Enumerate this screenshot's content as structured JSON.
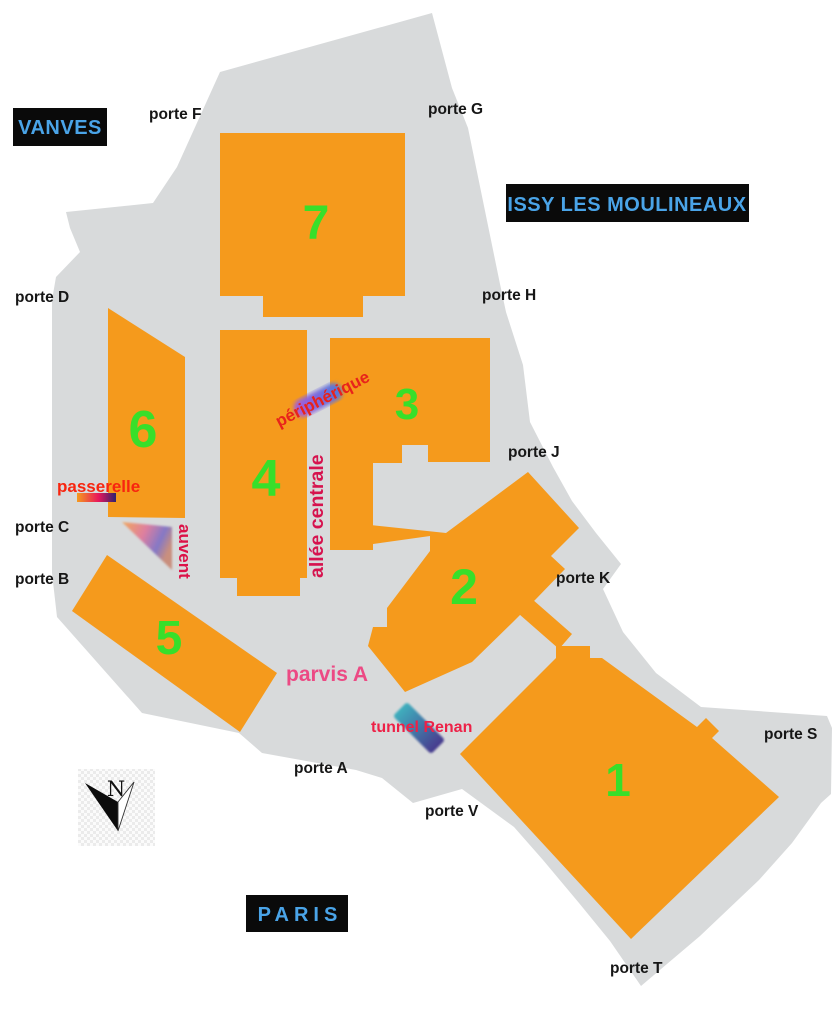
{
  "map": {
    "regions": {
      "vanves": "VANVES",
      "issy_les_moulineaux": "ISSY LES MOULINEAUX",
      "paris": "PARIS"
    },
    "halls": {
      "hall_1": "1",
      "hall_2": "2",
      "hall_3": "3",
      "hall_4": "4",
      "hall_5": "5",
      "hall_6": "6",
      "hall_7": "7"
    },
    "gates": {
      "porte_a": "porte A",
      "porte_b": "porte B",
      "porte_c": "porte C",
      "porte_d": "porte D",
      "porte_f": "porte F",
      "porte_g": "porte G",
      "porte_h": "porte H",
      "porte_j": "porte J",
      "porte_k": "porte K",
      "porte_s": "porte S",
      "porte_t": "porte T",
      "porte_v": "porte V"
    },
    "features": {
      "passerelle": "passerelle",
      "peripherique": "périphérique",
      "allee_centrale": "allée centrale",
      "auvent": "auvent",
      "parvis_a": "parvis A",
      "tunnel_renan": "tunnel Renan"
    },
    "compass_north": "N",
    "colors": {
      "hall_orange": "#F59A1C",
      "site_gray": "#D8DADB",
      "hall_number_green": "#38DF2A",
      "gate_label_black": "#161616",
      "region_box_black": "#0A0A0A",
      "region_label_blue": "#4AA4E8",
      "passerelle_red": "#F8250F",
      "peripherique_red": "#E8231B",
      "allee_centrale_crimson": "#D6134E",
      "auvent_crimson": "#DC1248",
      "parvis_pink": "#EC4A84",
      "tunnel_renan_red": "#ED2147"
    }
  }
}
